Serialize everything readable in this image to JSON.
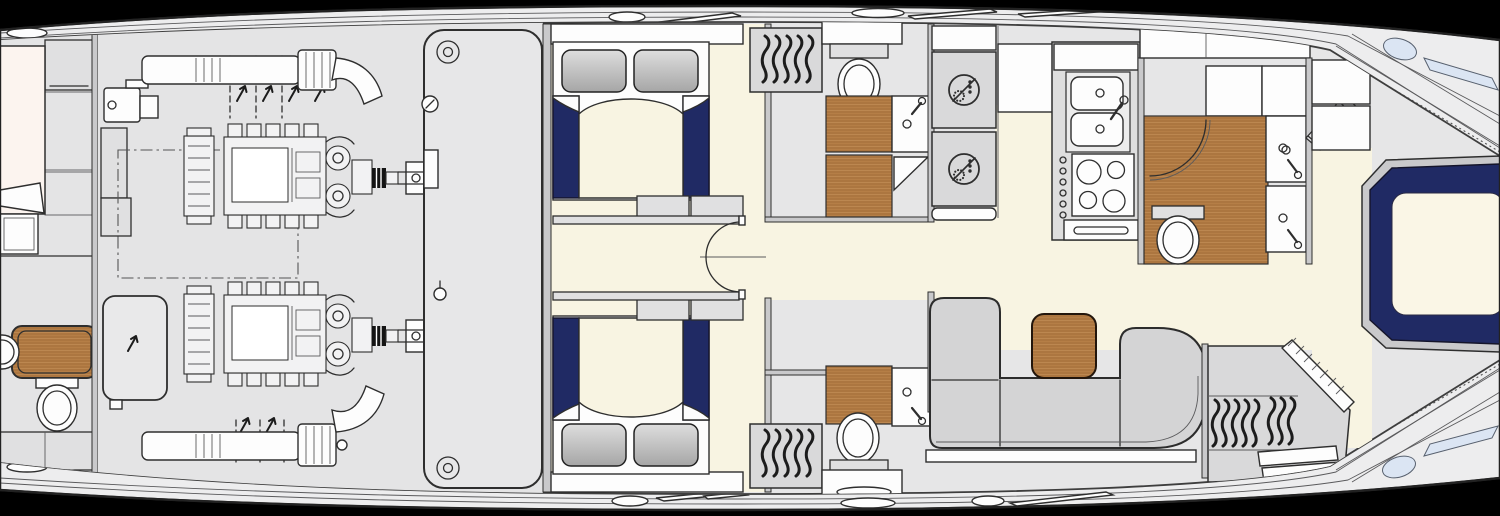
{
  "document": {
    "type": "yacht-lower-deck-floor-plan",
    "orientation": "bow-right"
  },
  "colors": {
    "background": "#000000",
    "hull": "#ededee",
    "interior": "#e6e6e7",
    "ink": "#2e2e2e",
    "cream": "#f8f4e2",
    "navy": "#202a64",
    "teak": "#b57e46",
    "teak-dark": "#9c6835",
    "panel": "#e0e0e1",
    "white": "#fdfdfd",
    "pillow-light": "#dedede",
    "pillow-dark": "#a6a6a6",
    "sofa": "#d4d4d5",
    "window-blue": "#dbe5f3",
    "wall": "#c9c9cb",
    "appliance": "#d9d9da"
  },
  "rooms": [
    {
      "id": "aft-cabin",
      "fixtures": [
        "bed",
        "round-sink",
        "teak-counter",
        "toilet"
      ]
    },
    {
      "id": "engine-room",
      "fixtures": [
        "port-engine",
        "starboard-engine",
        "exhaust-mufflers",
        "fuel-tank",
        "generator",
        "bulkhead-panel",
        "gauges"
      ]
    },
    {
      "id": "port-guest-cabin",
      "fixtures": [
        "double-bed",
        "pillows",
        "foot-shelf"
      ]
    },
    {
      "id": "starboard-guest-cabin",
      "fixtures": [
        "double-bed",
        "pillows",
        "foot-shelf"
      ]
    },
    {
      "id": "corridor",
      "fixtures": [
        "door-swing"
      ]
    },
    {
      "id": "port-head",
      "fixtures": [
        "wardrobe-hangers",
        "toilet",
        "sink",
        "teak-floor",
        "shower-door"
      ]
    },
    {
      "id": "starboard-head",
      "fixtures": [
        "wardrobe-hangers",
        "toilet",
        "sink",
        "teak-floor"
      ]
    },
    {
      "id": "laundry",
      "fixtures": [
        "washer",
        "dryer"
      ]
    },
    {
      "id": "galley",
      "fixtures": [
        "double-sink",
        "faucet",
        "four-burner-cooktop",
        "drawers"
      ]
    },
    {
      "id": "day-head",
      "fixtures": [
        "shower-enclosure",
        "toilet",
        "twin-sinks",
        "teak-floor",
        "lockers"
      ]
    },
    {
      "id": "stairs",
      "fixtures": [
        "companionway-steps"
      ]
    },
    {
      "id": "salon",
      "fixtures": [
        "l-shaped-sofa",
        "teak-table"
      ]
    },
    {
      "id": "bow-wardrobe",
      "fixtures": [
        "hangers",
        "drawers",
        "diagonal-bulkhead"
      ]
    },
    {
      "id": "bow-stateroom",
      "fixtures": [
        "island-bed-navy",
        "hull-windows"
      ]
    }
  ],
  "icons": [
    "toilet-icon",
    "sink-icon",
    "faucet-icon",
    "washer-icon",
    "hanger-icon",
    "stove-icon",
    "shower-icon",
    "stairs-icon",
    "window-icon",
    "gauge-icon",
    "bolt-icon",
    "door-swing-icon"
  ]
}
